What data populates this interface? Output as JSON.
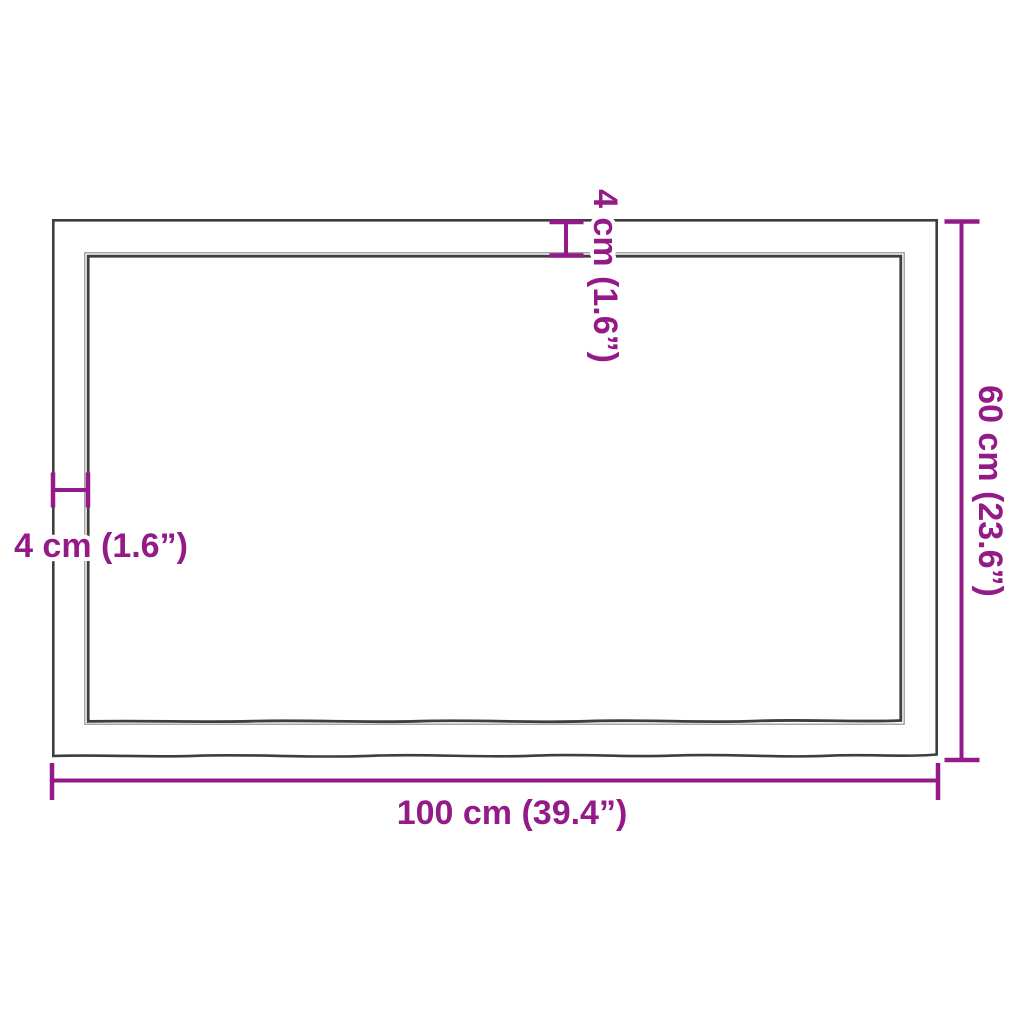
{
  "figure": {
    "name": "tabletop-dimension-diagram",
    "background": "#ffffff"
  },
  "colors": {
    "accent": "#941b87",
    "outline": "#3e3e3e",
    "outline_light": "#8f8f8f",
    "background": "#ffffff"
  },
  "labels": {
    "width": "100 cm (39.4”)",
    "height": "60 cm (23.6”)",
    "edge_thickness_left": "4 cm (1.6”)",
    "edge_thickness_top": "4 cm (1.6”)"
  },
  "values": {
    "width_cm": 100,
    "width_in": 39.4,
    "height_cm": 60,
    "height_in": 23.6,
    "edge_thickness_cm": 4,
    "edge_thickness_in": 1.6
  }
}
